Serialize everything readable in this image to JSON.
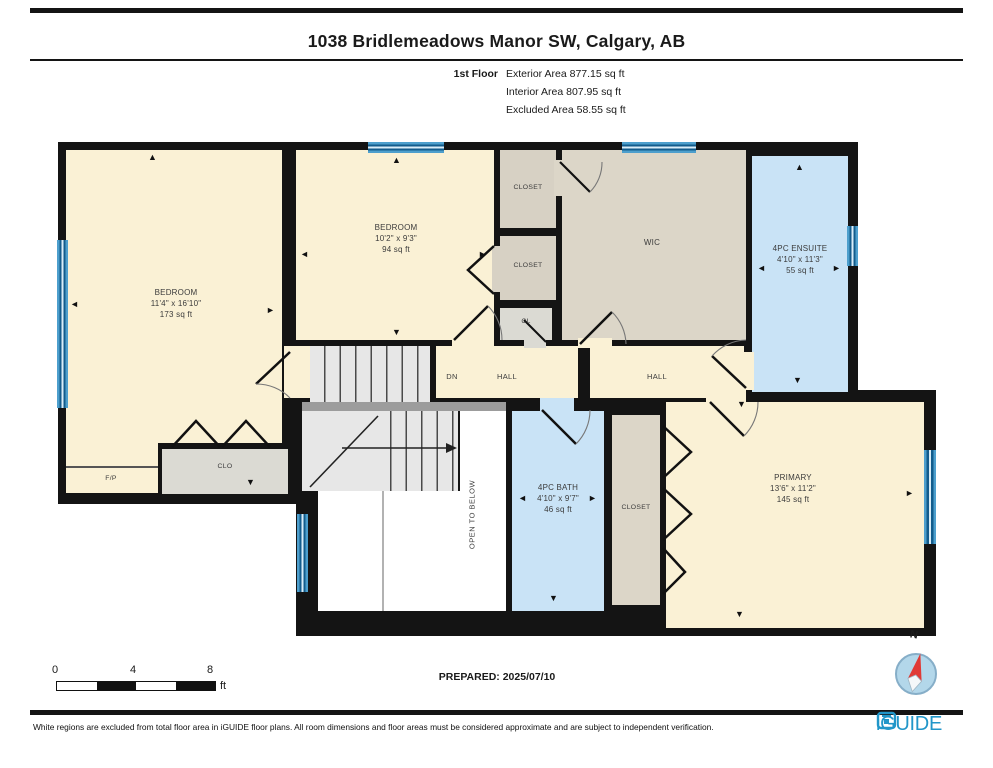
{
  "header": {
    "title": "1038 Bridlemeadows Manor SW, Calgary, AB",
    "floor_label": "1st Floor",
    "area_lines": {
      "exterior": "Exterior Area 877.15 sq ft",
      "interior": "Interior Area 807.95 sq ft",
      "excluded": "Excluded Area 58.55 sq ft"
    }
  },
  "rooms": {
    "bedroom_left": {
      "name": "BEDROOM",
      "dims": "11'4\" x 16'10\"",
      "area": "173 sq ft"
    },
    "bedroom_mid": {
      "name": "BEDROOM",
      "dims": "10'2\" x 9'3\"",
      "area": "94 sq ft"
    },
    "ensuite": {
      "name": "4PC ENSUITE",
      "dims": "4'10\" x 11'3\"",
      "area": "55 sq ft"
    },
    "bath": {
      "name": "4PC BATH",
      "dims": "4'10\" x 9'7\"",
      "area": "46 sq ft"
    },
    "primary": {
      "name": "PRIMARY",
      "dims": "13'6\" x 11'2\"",
      "area": "145 sq ft"
    }
  },
  "labels": {
    "wic": "WIC",
    "closet_top": "CLOSET",
    "closet_mid": "CLOSET",
    "closet_br": "CLOSET",
    "cl": "CL",
    "clo": "CLO",
    "fp": "F/P",
    "dn": "DN",
    "hall_left": "HALL",
    "hall_right": "HALL",
    "open_below": "OPEN TO BELOW"
  },
  "glyphs": {
    "up": "▲",
    "down": "▼",
    "left": "◄",
    "right": "►"
  },
  "footer": {
    "scale": {
      "t0": "0",
      "t1": "4",
      "t2": "8",
      "unit": "ft"
    },
    "prepared": "PREPARED: 2025/07/10",
    "compass_label": "N",
    "disclaimer": "White regions are excluded from total floor area in iGUIDE floor plans. All room dimensions and floor areas must be considered approximate and are subject to independent verification.",
    "brand": "iGUIDE"
  },
  "colors": {
    "cream": "#faf1d5",
    "greige": "#dcd6c8",
    "tan2": "#d7d1c4",
    "gray_room": "#dbdad3",
    "blue_room": "#c9e3f6",
    "stairs": "#e7e7e7",
    "landing": "#9c9c9c",
    "wall": "#141414",
    "window_frame": "#4d9fcd",
    "window_dark": "#135c8c",
    "window_light": "#d9edf8",
    "brand": "#2196c9",
    "compass_fill": "#b3d7ea",
    "needle_red": "#e03a36",
    "label": "#3b3b3b"
  }
}
